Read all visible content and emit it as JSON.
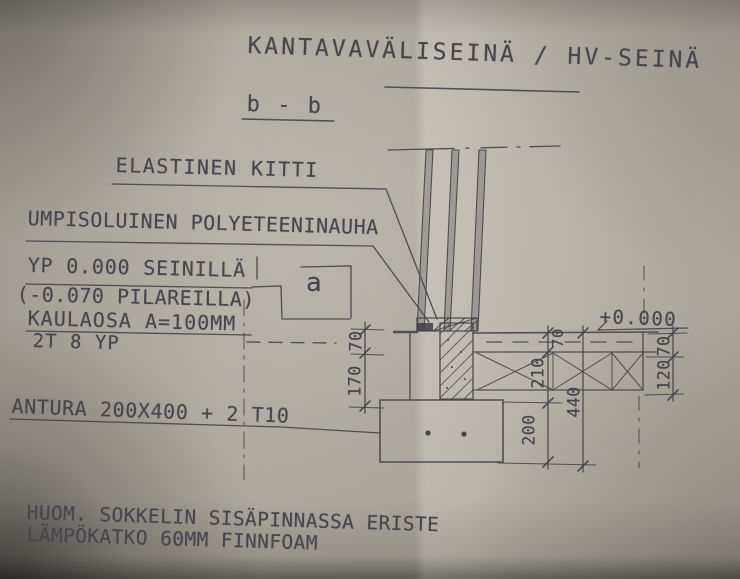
{
  "title": {
    "main": "KANTAVAVÄLISEINÄ / HV-SEINÄ",
    "section_ref": "b - b"
  },
  "callouts": {
    "elastic_sealant": "ELASTINEN KITTI",
    "pe_strip": "UMPISOLUINEN POLYETEENINAUHA",
    "level_walls": "YP 0.000 SEINILLÄ",
    "level_columns": "(-0.070 PILAREILLA)",
    "neck": "KAULAOSA A=100MM",
    "top_rebar": "2T 8 YP",
    "footing": "ANTURA 200X400 + 2 T10",
    "section_marker": "a",
    "floor_level": "+0.000"
  },
  "dimensions": {
    "left_upper": "70",
    "left_lower": "170",
    "mid_slab": "70",
    "mid_plinth": "210",
    "mid_footing": "200",
    "overall": "440",
    "right_slab": "70",
    "right_base": "120"
  },
  "note": {
    "line1": "HUOM. SOKKELIN SISÄPINNASSA ERISTE",
    "line2": "LÄMPÖKATKO 60MM FINNFOAM"
  },
  "colors": {
    "paper": "#b4afa5",
    "ink": "#45444c"
  }
}
